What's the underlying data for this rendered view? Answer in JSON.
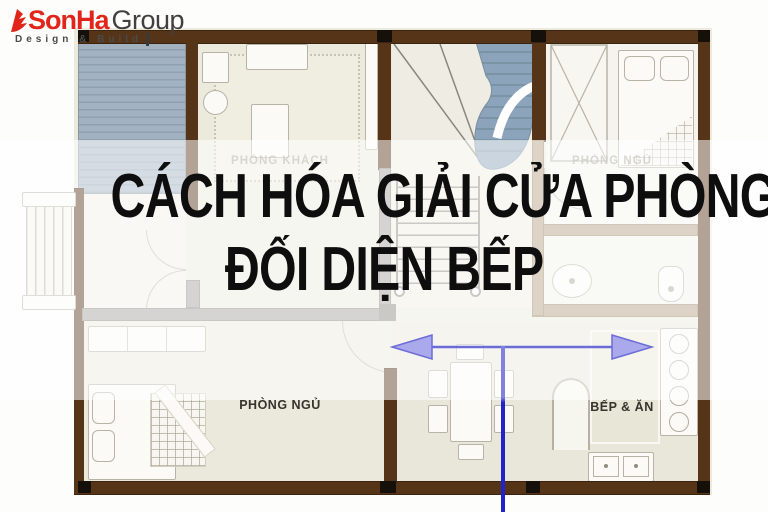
{
  "logo": {
    "brand_red": "SonHa",
    "brand_dark": "Group",
    "tagline": "Design & Build"
  },
  "title": {
    "line1": "CÁCH HÓA GIẢI CỬA PHÒNG NGỦ",
    "line2": "ĐỐI DIỆN BẾP"
  },
  "plan": {
    "labels": {
      "living_room": "PHÒNG KHÁCH",
      "bedroom_top": "PHÒNG NGỦ",
      "bedroom_bottom": "PHÒNG NGỦ",
      "kitchen": "BẾP & ĂN"
    },
    "icons": {
      "flame": "sonha-flame-icon",
      "arrow": "double-headed-horizontal-arrow",
      "guide": "vertical-guide-line"
    },
    "colors": {
      "wall": "#553418",
      "floor": "#eceadd",
      "deck": "#a2b2c1",
      "stair": "#8ba3bb",
      "arrow_fill": "#a9a9ec",
      "arrow_line": "#6c6cd8",
      "guide_line": "#2323cb",
      "brand_red": "#e1251b",
      "title_color": "#0e0e0e"
    }
  }
}
